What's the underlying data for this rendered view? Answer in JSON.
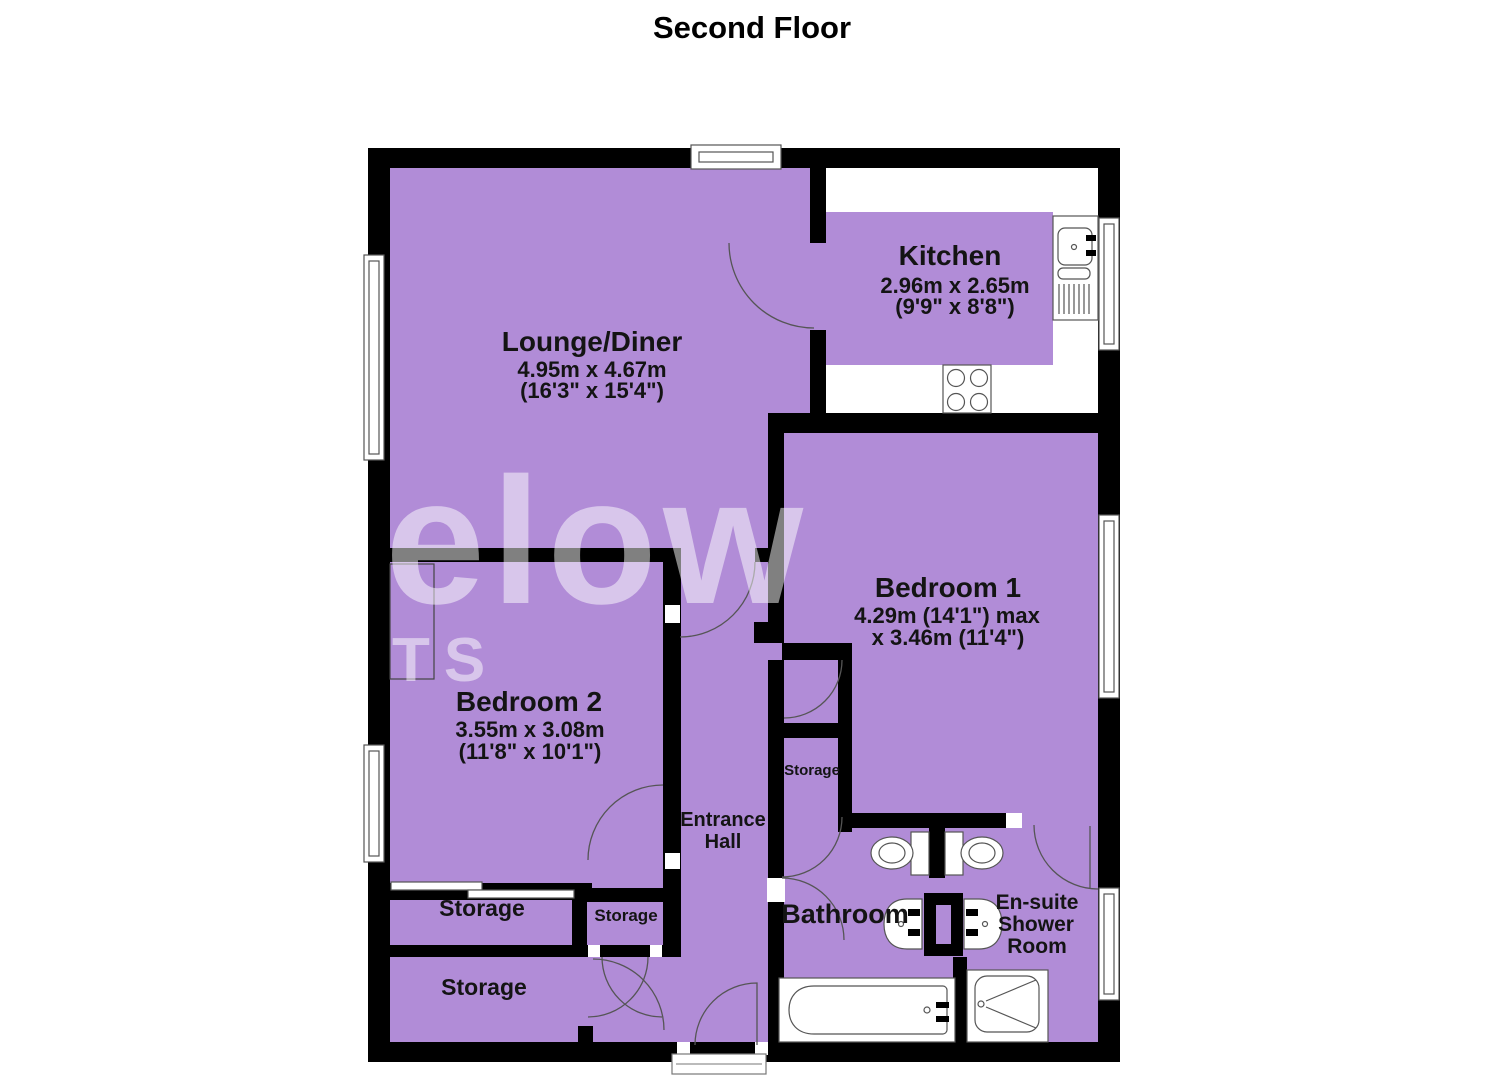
{
  "title": "Second Floor",
  "watermark": {
    "line1": "elow",
    "line2": "TS"
  },
  "rooms": {
    "lounge": {
      "name": "Lounge/Diner",
      "dims1": "4.95m x 4.67m",
      "dims2": "(16'3\" x 15'4\")"
    },
    "kitchen": {
      "name": "Kitchen",
      "dims1": "2.96m x 2.65m",
      "dims2": "(9'9\" x 8'8\")"
    },
    "bedroom1": {
      "name": "Bedroom 1",
      "dims1": "4.29m (14'1\") max",
      "dims2": "x 3.46m (11'4\")"
    },
    "bedroom2": {
      "name": "Bedroom 2",
      "dims1": "3.55m x 3.08m",
      "dims2": "(11'8\" x 10'1\")"
    },
    "hall": {
      "line1": "Entrance",
      "line2": "Hall"
    },
    "bathroom": {
      "name": "Bathroom"
    },
    "ensuite": {
      "line1": "En-suite",
      "line2": "Shower",
      "line3": "Room"
    },
    "storage_hall": {
      "name": "Storage"
    },
    "storage_mid": {
      "name": "Storage"
    },
    "storage_small": {
      "name": "Storage"
    },
    "storage_bottom": {
      "name": "Storage"
    }
  },
  "colors": {
    "room_fill": "#b18cd7",
    "wall": "#000000",
    "outline": "#555555",
    "watermark": "rgba(255,255,255,0.5)"
  }
}
